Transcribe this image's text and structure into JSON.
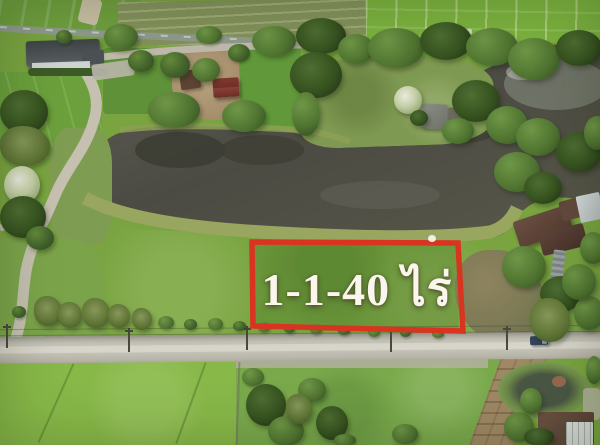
{
  "annotation": {
    "area_label": "1-1-40 ไร่",
    "box_color": "#d83420",
    "label_color": "#faf6ee"
  }
}
